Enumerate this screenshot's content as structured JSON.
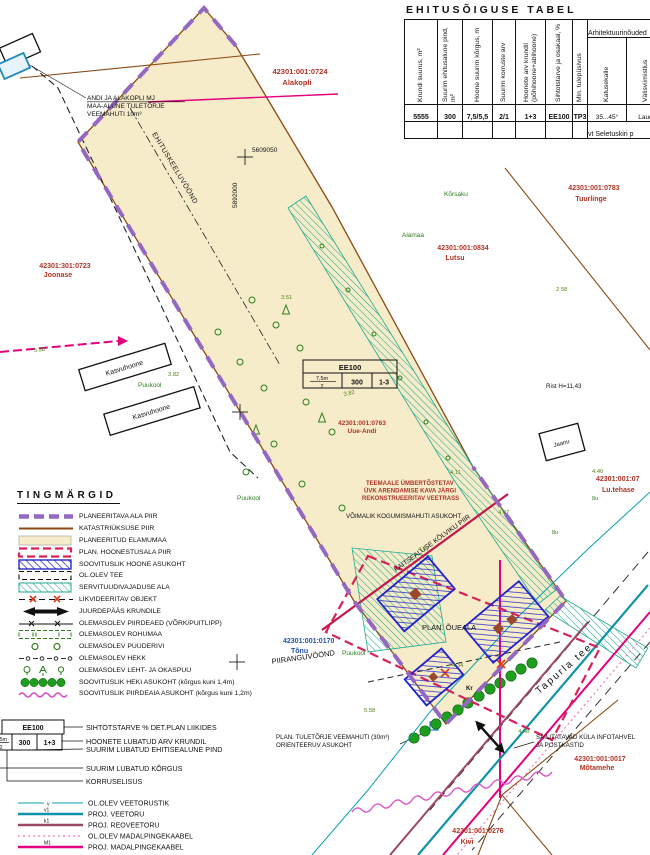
{
  "colors": {
    "planned_area_boundary": "#9468c0",
    "cadastral_line": "#8a4a12",
    "residential_fill": "#f6ecca",
    "building_zone_red": "#d62258",
    "building_hatch_blue": "#2a2ac8",
    "servitude_teal": "#1fa98f",
    "utility_magenta": "#e5007e",
    "vegetation_green": "#2e7d1e"
  },
  "table": {
    "title": "EHITUSÕIGUSE TABEL",
    "columns": [
      {
        "header": "Krundi suurus, m²",
        "value": "5555"
      },
      {
        "header": "Suurim ehitusalune pind, m²",
        "value": "300"
      },
      {
        "header": "Hoone suurim kõrgus, m",
        "value": "7,5/5,5"
      },
      {
        "header": "Suurim korruste arv",
        "value": "2/1"
      },
      {
        "header": "Hoonete arv krundil (põhihoone+abihoone)",
        "value": "1+3"
      },
      {
        "header": "Sihtotstarve ja osakaal, %",
        "value": "EE100"
      },
      {
        "header": "Min. tulepüsivus",
        "value": "TP3"
      }
    ],
    "arch": {
      "header": "Arhitektuurinõuded",
      "columns": [
        {
          "header": "Katusekalle",
          "value": "35...45°"
        },
        {
          "header": "Välisviimistlus",
          "value": "Laud"
        }
      ],
      "note": "vt Seletuskiri p"
    }
  },
  "legend": {
    "title": "TINGMÄRGID",
    "items": [
      "PLANEERITAVA ALA PIIR",
      "KATASTRIÜKSUSE PIIR",
      "PLANEERITUD ELAMUMAA",
      "PLAN. HOONESTUSALA PIIR",
      "SOOVITUSLIK HOONE ASUKOHT",
      "OL.OLEV TEE",
      "SERVITUUDIVAJADUSE ALA",
      "LIKVIDEERITAV OBJEKT",
      "JUURDEPÄÄS KRUNDILE",
      "OLEMASOLEV PIIRDEAED (VÕRK/PUITLIPP)",
      "OLEMASOLEV ROHUMAA",
      "OLEMASOLEV PUUDERIVI",
      "OLEMASOLEV HEKK",
      "OLEMASOLEV LEHT- JA OKASPUU",
      "SOOVITUSLIK HEKI ASUKOHT (kõrgus kuni 1,4m)",
      "SOOVITUSLIK PIIRDEAIA ASUKOHT (kõrgus kuni 1,2m)"
    ],
    "callout": {
      "code": "EE100",
      "height": "7,5m",
      "floors": "2",
      "area": "300",
      "count": "1+3",
      "labels": [
        "SIHTOTSTARVE % DET.PLAN LIIKIDES",
        "HOONETE LUBATUD ARV KRUNDIL",
        "SUURIM LUBATUD EHITISEALUNE PIND",
        "SUURIM LUBATUD KÕRGUS",
        "KORRUSELISUS"
      ]
    },
    "utilities": [
      {
        "tag": "v",
        "label": "OL.OLEV VEETORUSTIK"
      },
      {
        "tag": "v1",
        "label": "PROJ. VEETORU"
      },
      {
        "tag": "k1",
        "label": "PROJ. REOVEETORU"
      },
      {
        "tag": "",
        "label": "OL.OLEV MADALPINGEKAABEL"
      },
      {
        "tag": "M1",
        "label": "PROJ. MADALPINGEKAABEL"
      }
    ]
  },
  "map": {
    "grid": {
      "x": "5609050",
      "y": "5892000"
    },
    "zones": {
      "ehituskeeluvoond": "EHITUSKEELUVÖÖND",
      "piiranguvoond": "PIIRANGUVÖÖND",
      "kaitsealune": "KAITSEALUSE KÕLVIKU PIIR",
      "plan_oueala": "PLAN. ÕUEALA"
    },
    "road": "Tapurla tee",
    "parcels": {
      "alakopli": {
        "code": "42301:001:0724",
        "name": "Alakopli"
      },
      "tuurlinge": {
        "code": "42301:001:0783",
        "name": "Tuurlinge"
      },
      "lutsu": {
        "code": "42301:001:0834",
        "name": "Lutsu"
      },
      "joonase": {
        "code": "42301:301:0723",
        "name": "Joonase"
      },
      "uueandi": {
        "code": "42301:001:0763",
        "name": "Uue-Andi"
      },
      "tonu": {
        "code": "42301:001:0170",
        "name": "Tõnu"
      },
      "motamehe": {
        "code": "42301:001:0017",
        "name": "Mõtamehe"
      },
      "kivi": {
        "code": "42301:001:0276",
        "name": "Kivi"
      },
      "lutehase": {
        "code": "42301:001:07",
        "name": "Lu.tehase"
      }
    },
    "notes": {
      "veemahuti": [
        "ANDI JA ALAKOPLI MJ",
        "MAA-ALUNE TULETÕRJE",
        "VEEMAHUTI 10m³"
      ],
      "veetrass": [
        "TEEMAALE ÜMBERTÕSTETAV",
        "ÜVK ARENDAMISE KAVA JÄRGI",
        "REKONSTRUEERITAV VEETRASS"
      ],
      "kogumismahuti": "VÕIMALIK KOGUMISMAHUTI ASUKOHT",
      "infotahvel": [
        "SÄILITATAVAD KÜLA INFOTAHVEL",
        "JA POSTKASTID"
      ],
      "plan_veemahuti": [
        "PLAN. TULETÕRJE VEEMAHUTI (30m³)",
        "ORIENTEERUV ASUKOHT"
      ]
    },
    "features": {
      "kasvuhoone1": "Kasvuhoone",
      "kasvuhoone2": "Kasvuhoone",
      "puukool1": "Puukool",
      "puukool2": "Puukool",
      "puukool3": "Puukool",
      "jaanu": "Jaanu",
      "alamaa": "Alamaa",
      "korsaku": "Kõrsaku",
      "rist": "Rist H=11,43",
      "kr": "Kr"
    },
    "infobox": {
      "code": "EE100",
      "height": "7,5m",
      "floors": "2",
      "area": "300",
      "count": "1-3"
    },
    "elevations": [
      "3.51",
      "3.82",
      "3.82",
      "4.47",
      "4.34",
      "4.07",
      "4.40",
      "4.11",
      "5.58",
      "4.48",
      "2.58",
      "5.38"
    ],
    "tree_tags": [
      "8u",
      "8u"
    ]
  }
}
